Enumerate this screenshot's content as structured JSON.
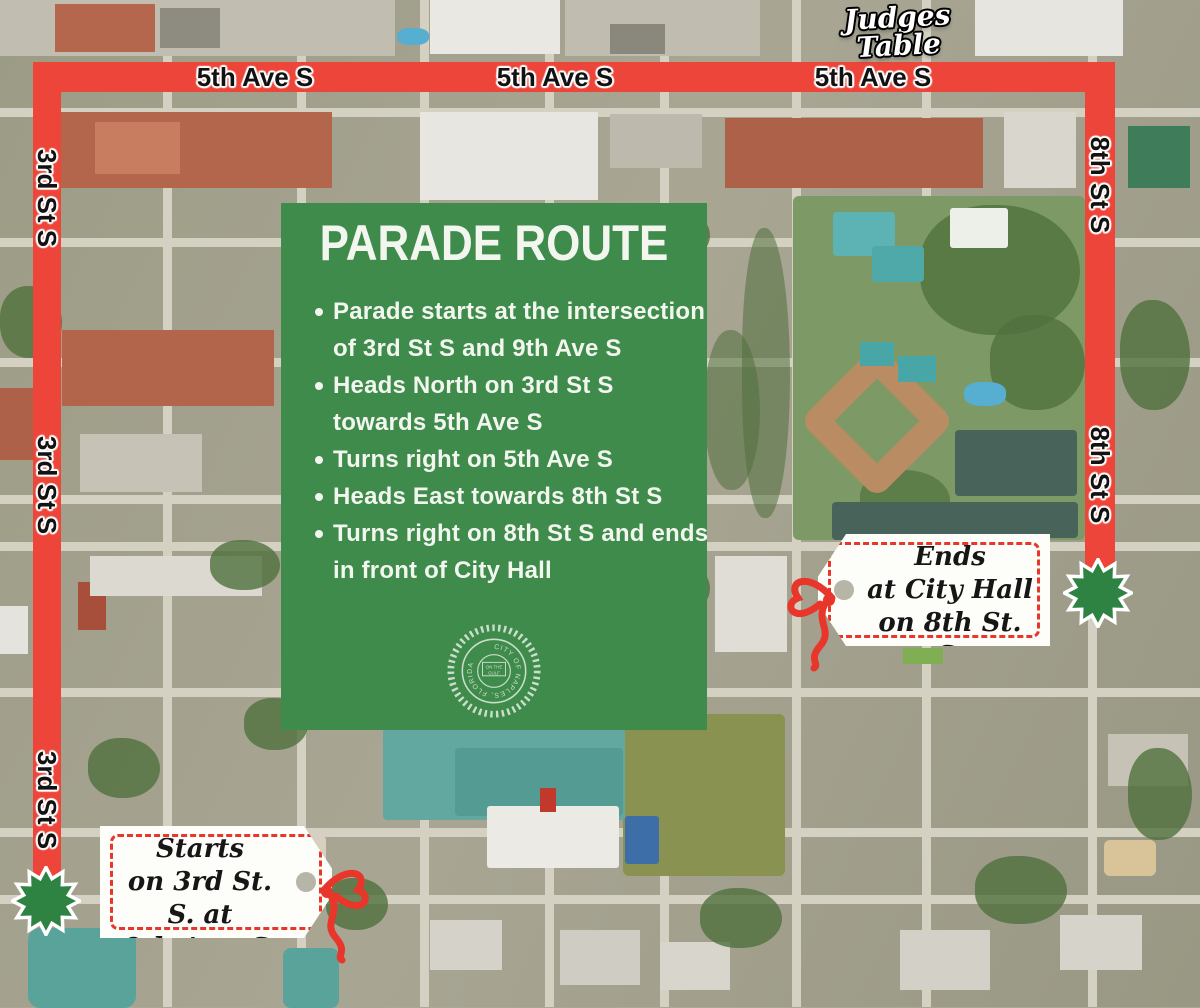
{
  "route": {
    "street_labels": {
      "top": [
        "5th Ave S",
        "5th Ave S",
        "5th Ave S"
      ],
      "left": [
        "3rd St S",
        "3rd St S",
        "3rd St S"
      ],
      "right": [
        "8th St S",
        "8th St S"
      ]
    }
  },
  "judges_table": {
    "line1": "Judges",
    "line2": "Table"
  },
  "panel": {
    "title": "PARADE ROUTE",
    "bullets": [
      "Parade starts at the intersection of 3rd St S and 9th Ave S",
      "Heads North on 3rd St S towards 5th Ave S",
      "Turns right on 5th Ave S",
      "Heads East towards 8th St S",
      "Turns right on 8th St S and ends in front of City Hall"
    ],
    "seal": {
      "ring_text": "CITY OF NAPLES, FLORIDA",
      "center_top": "ON THE",
      "center_bottom": "GULF"
    }
  },
  "tags": {
    "parade_ends": {
      "line1": "Parade Ends",
      "line2": "at City Hall",
      "line3": "on 8th St. S."
    },
    "parade_starts": {
      "line1": "Parade Starts",
      "line2": "on 3rd St. S. at",
      "line3": "9th Ave. S."
    }
  },
  "colors": {
    "route_red": "#ed4539",
    "panel_green": "#3e8b4b",
    "starburst_green": "#2e8342",
    "tag_red": "#e8362b",
    "map_base": "#a8a593"
  }
}
